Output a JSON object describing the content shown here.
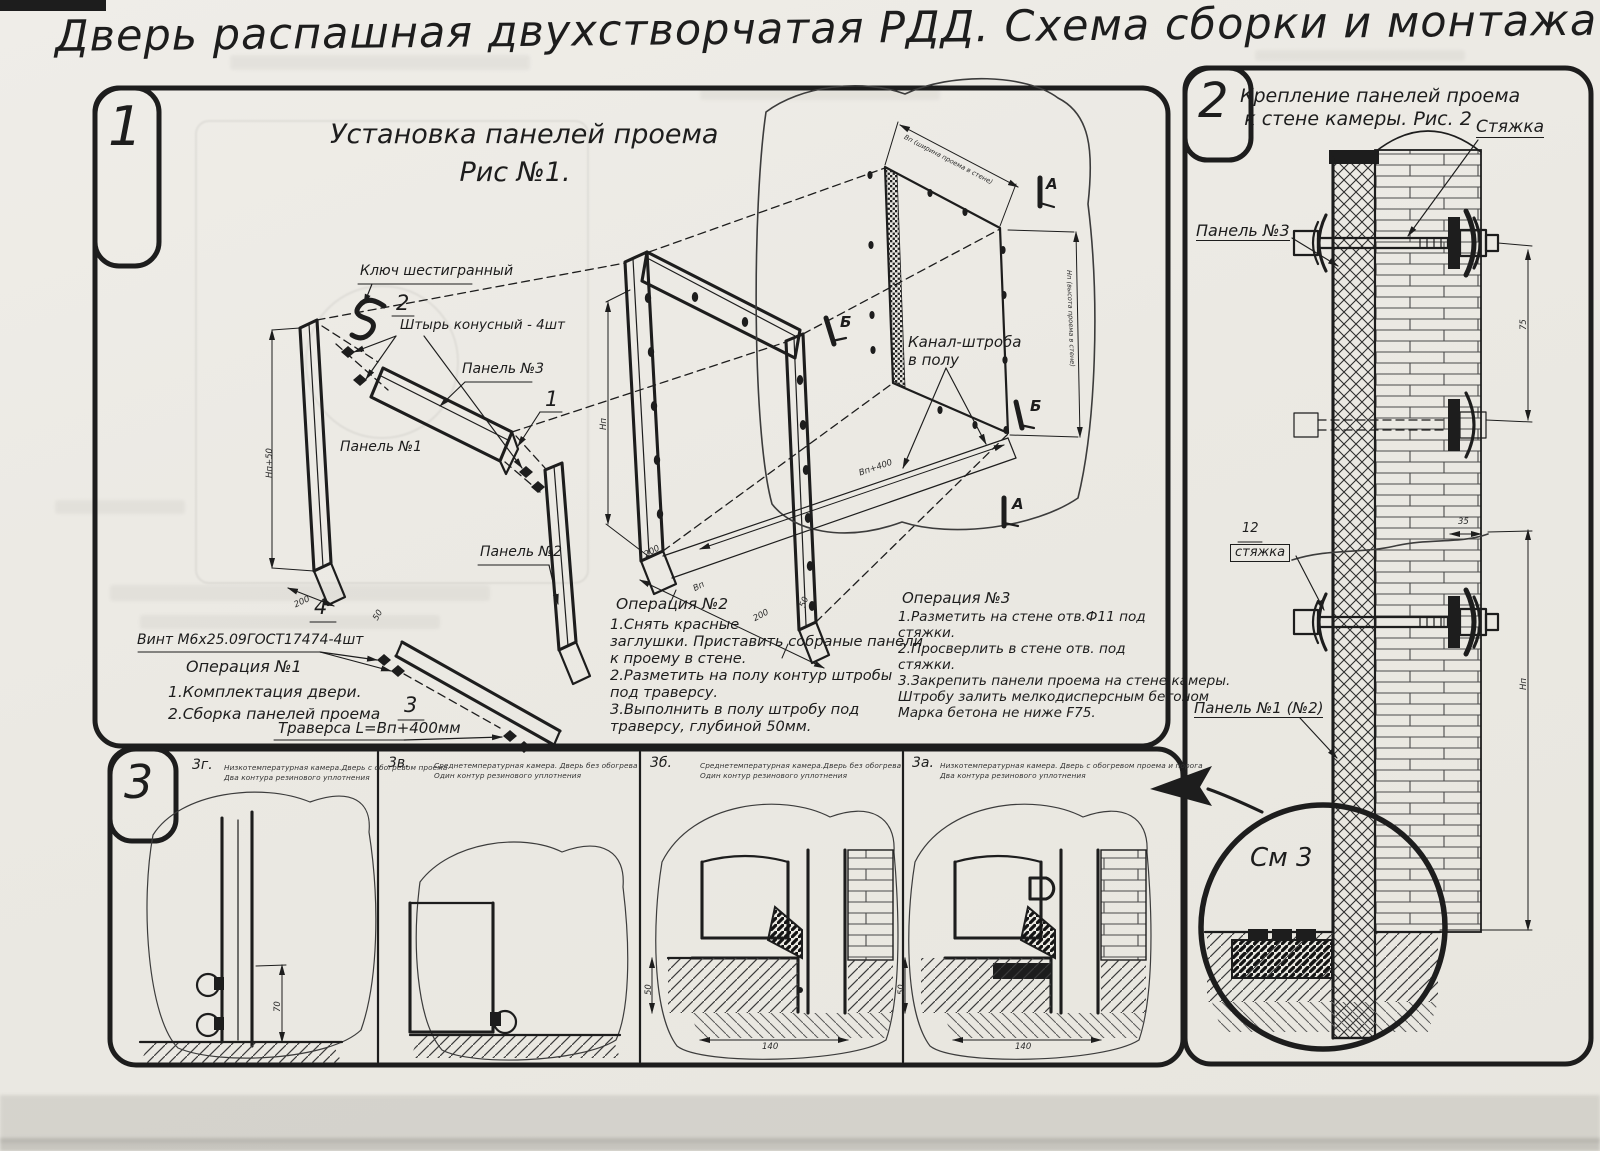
{
  "title": "Дверь распашная двухстворчатая РДД.  Схема сборки и монтажа №2",
  "palette": {
    "ink": "#1d1d1d",
    "paper": "#edebe5"
  },
  "fig1": {
    "tab": "1",
    "heading": [
      "Установка панелей проема",
      "Рис №1."
    ],
    "labels": {
      "hex_key": "Ключ шестигранный",
      "pin": "Штырь конусный - 4шт",
      "panel3": "Панель №3",
      "panel1": "Панель №1",
      "panel2": "Панель №2",
      "screw": "Винт М6х25.09ГОСТ17474-4шт",
      "traverse": "Траверса  L=Вп+400мм",
      "channel": [
        "Канал-штроба",
        "в полу"
      ]
    },
    "balloons": {
      "b1": "1",
      "b2": "2",
      "b3": "3",
      "b4": "4"
    },
    "markers": {
      "a": "А",
      "b": "Б"
    },
    "dims": {
      "np50": "Нп+50",
      "d200": "200",
      "np": "Нп",
      "bp": "Вп",
      "d50": "50",
      "bp400": "Вп+400",
      "bp_top": "Вп (ширина проема в стене)",
      "np_right": "Нп (высота проема в стене)"
    },
    "op1": {
      "title": "Операция №1",
      "lines": [
        "1.Комплектация двери.",
        "2.Сборка панелей проема"
      ]
    },
    "op2": {
      "title": "Операция №2",
      "lines": [
        "1.Снять красные",
        "заглушки. Приставить собраные панели",
        "к проему в стене.",
        "2.Разметить на полу контур штробы",
        "под траверсу.",
        "3.Выполнить в полу штробу под",
        "траверсу, глубиной 50мм."
      ]
    },
    "op3": {
      "title": "Операция №3",
      "lines": [
        "1.Разметить на стене отв.Ф11 под",
        "стяжки.",
        "2.Просверлить в стене отв.  под",
        "стяжки.",
        "3.Закрепить панели проема на стене камеры.",
        "Штробу залить мелкодисперсным бетоном",
        "Марка бетона не ниже  F75."
      ]
    }
  },
  "fig2": {
    "tab": "2",
    "heading": [
      "Крепление панелей проема",
      "к стене камеры. Рис. 2"
    ],
    "labels": {
      "tie": "Стяжка",
      "panel3": "Панель №3",
      "pos": "12",
      "tie_boxed": "стяжка",
      "panel12": "Панель №1 (№2)",
      "see": "См 3"
    },
    "dims": {
      "d35": "35",
      "d75": "75",
      "np": "Нп"
    }
  },
  "fig3": {
    "tab": "3",
    "details": [
      {
        "id": "3г.",
        "caption": [
          "Низкотемпературная камера.Дверь с обогревом проема",
          "Два контура резинового уплотнения"
        ],
        "dim_h": "70"
      },
      {
        "id": "3в.",
        "caption": [
          "Среднетемпературная камера. Дверь без обогрева",
          "Один контур резинового уплотнения"
        ]
      },
      {
        "id": "3б.",
        "caption": [
          "Среднетемпературная камера.Дверь без обогрева",
          "Один контур резинового уплотнения"
        ],
        "dim_depth": "50",
        "dim_width": "140"
      },
      {
        "id": "3а.",
        "caption": [
          "Низкотемпературная камера. Дверь с обогревом проема и порога",
          "Два контура резинового уплотнения"
        ],
        "dim_depth": "50",
        "dim_width": "140"
      }
    ]
  }
}
